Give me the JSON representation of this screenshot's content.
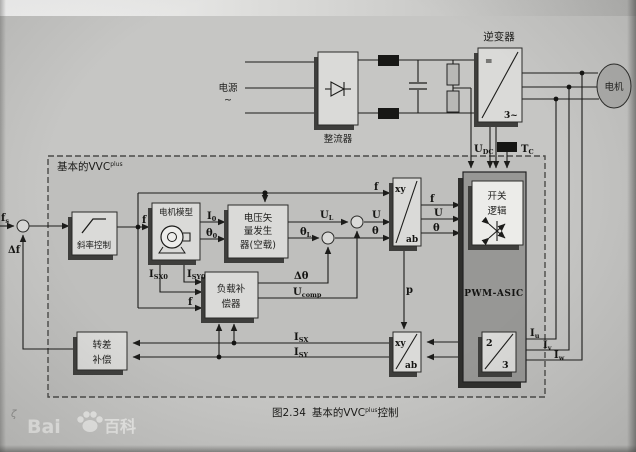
{
  "caption": {
    "fig": "图2.34",
    "title": "基本的VVC",
    "sup": "plus",
    "suffix": "控制"
  },
  "power": {
    "source": "电源",
    "tilde": "~",
    "rectifier": "整流器",
    "inverter": "逆变器",
    "inverter_dc": "=",
    "inverter_ac": "3~",
    "motor": "电机",
    "udc_base": "U",
    "udc_sub": "DC",
    "tc_base": "T",
    "tc_sub": "C"
  },
  "vvc": {
    "title": "基本的VVC",
    "title_sup": "plus"
  },
  "blocks": {
    "ramp": "斜率控制",
    "motor_model": "电机模型",
    "vvg1": "电压矢",
    "vvg2": "量发生",
    "vvg3": "器(空载)",
    "load1": "负载补",
    "load2": "偿器",
    "slip1": "转差",
    "slip2": "补偿",
    "sw1": "开关",
    "sw2": "逻辑",
    "pwm": "PWM-ASIC",
    "xy": "xy",
    "ab": "ab",
    "two": "2",
    "three": "3"
  },
  "signals": {
    "fs_base": "f",
    "fs_sub": "s",
    "df": "Δf",
    "f": "f",
    "i0_base": "I",
    "i0_sub": "0",
    "th0_base": "θ",
    "th0_sub": "0",
    "ul_base": "U",
    "ul_sub": "L",
    "thl_base": "θ",
    "thl_sub": "L",
    "u": "U",
    "theta": "θ",
    "isx0_base": "I",
    "isx0_sub": "SX0",
    "isy0_base": "I",
    "isy0_sub": "SY0",
    "dtheta": "Δθ",
    "ucomp_base": "U",
    "ucomp_sub": "comp",
    "p": "p",
    "isx_base": "I",
    "isx_sub": "SX",
    "isy_base": "I",
    "isy_sub": "SY",
    "iu_base": "I",
    "iu_sub": "u",
    "iv_base": "I",
    "iv_sub": "v",
    "iw_base": "I",
    "iw_sub": "w"
  },
  "watermark": {
    "bai": "Bai",
    "baike": "百科",
    "mark": "ζ"
  }
}
